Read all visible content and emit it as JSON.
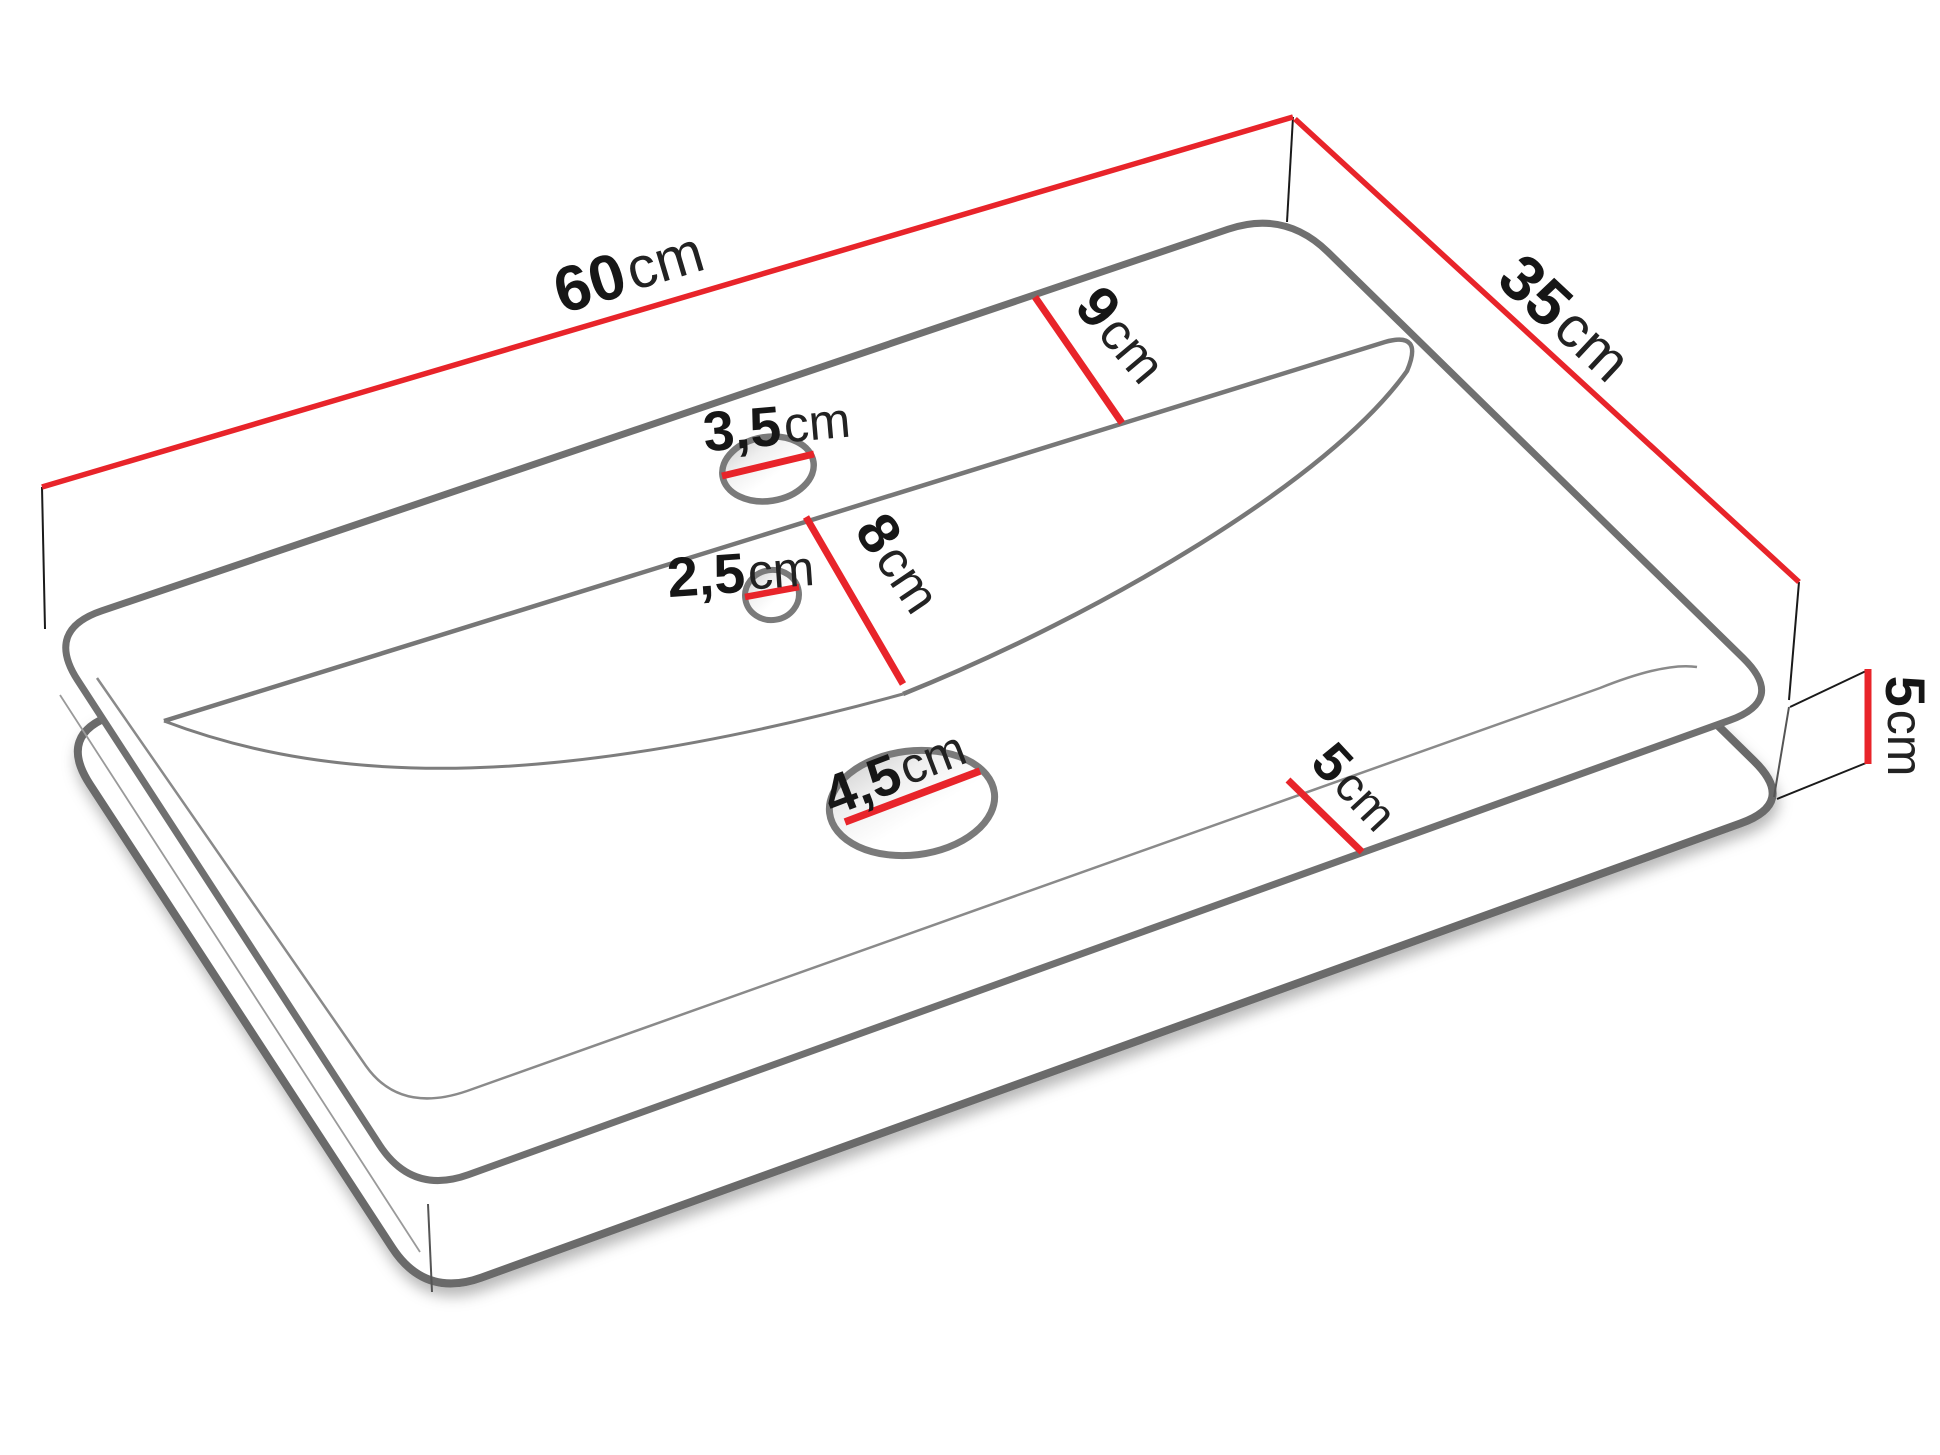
{
  "diagram": {
    "type": "technical-drawing",
    "subject": "washbasin countertop, perspective view with dimensions",
    "unit": "cm",
    "colors": {
      "dimension_accent": "#e8242a",
      "outline_gray": "#707070",
      "label_text": "#161616"
    },
    "measurements": {
      "width": {
        "value": "60",
        "unit": "cm"
      },
      "depth": {
        "value": "35",
        "unit": "cm"
      },
      "height": {
        "value": "5",
        "unit": "cm"
      },
      "back_rim": {
        "value": "9",
        "unit": "cm"
      },
      "hole_offset": {
        "value": "8",
        "unit": "cm"
      },
      "front_rim": {
        "value": "5",
        "unit": "cm"
      },
      "faucet_hole": {
        "value": "3,5",
        "unit": "cm"
      },
      "mounting_hole": {
        "value": "2,5",
        "unit": "cm"
      },
      "drain_hole": {
        "value": "4,5",
        "unit": "cm"
      }
    }
  }
}
